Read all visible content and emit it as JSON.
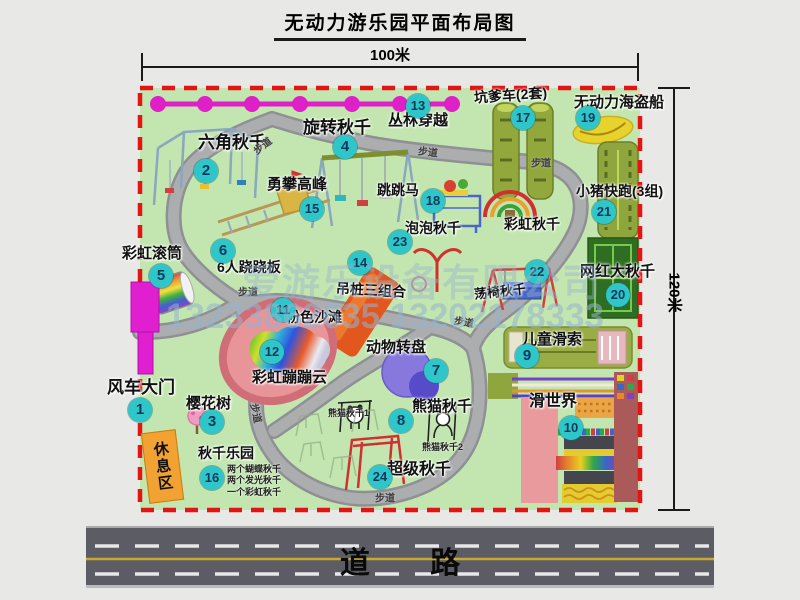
{
  "title": "无动力游乐园平面布局图",
  "dimensions": {
    "width": "100米",
    "height": "120米"
  },
  "road_label": "道 路",
  "trail_label": "步道",
  "rest_area_label": "休息区",
  "watermark": {
    "company": "爱游乐设备有限公司",
    "phone": "13233862635 13202178333"
  },
  "colors": {
    "map_green": "#c3e6b0",
    "border_red": "#e21414",
    "badge_cyan": "#2fc6c9",
    "gate_magenta": "#e01fd0",
    "rest_orange": "#f2a233"
  },
  "pois": {
    "p1": {
      "num": "1",
      "label": "风车大门"
    },
    "p2": {
      "num": "2",
      "label": "六角秋千"
    },
    "p3": {
      "num": "3",
      "label": "樱花树"
    },
    "p4": {
      "num": "4",
      "label": "旋转秋千"
    },
    "p5": {
      "num": "5",
      "label": "彩虹滚筒"
    },
    "p6": {
      "num": "6",
      "label": "6人跷跷板"
    },
    "p7": {
      "num": "7",
      "label": "动物转盘"
    },
    "p8": {
      "num": "8",
      "label": "熊猫秋千"
    },
    "p9": {
      "num": "9",
      "label": "儿童滑索"
    },
    "p10": {
      "num": "10",
      "label": "滑世界"
    },
    "p11": {
      "num": "11",
      "label": "粉色沙滩"
    },
    "p12": {
      "num": "12",
      "label": "彩虹蹦蹦云"
    },
    "p13": {
      "num": "13",
      "label": "丛林穿越"
    },
    "p14": {
      "num": "14",
      "label": "吊桩三组合"
    },
    "p15": {
      "num": "15",
      "label": "勇攀高峰"
    },
    "p16": {
      "num": "16",
      "label": "秋千乐园"
    },
    "p17": {
      "num": "17",
      "label": "坑爹车(2套)"
    },
    "p18": {
      "num": "18",
      "label": "跳跳马"
    },
    "p19": {
      "num": "19",
      "label": "无动力海盗船"
    },
    "p20": {
      "num": "20",
      "label": "网红大秋千"
    },
    "p21": {
      "num": "21",
      "label": "小猪快跑(3组)"
    },
    "p22": {
      "num": "22",
      "label": "荡椅秋千"
    },
    "p23": {
      "num": "23",
      "label": "泡泡秋千"
    },
    "p24": {
      "num": "24",
      "label": "超级秋千"
    },
    "rainbow": {
      "label": "彩虹秋千"
    }
  },
  "notes": {
    "panda1": "熊猫秋千1",
    "panda2": "熊猫秋千2",
    "swing_park": [
      "两个蝴蝶秋千",
      "两个发光秋千",
      "一个彩虹秋千"
    ]
  }
}
